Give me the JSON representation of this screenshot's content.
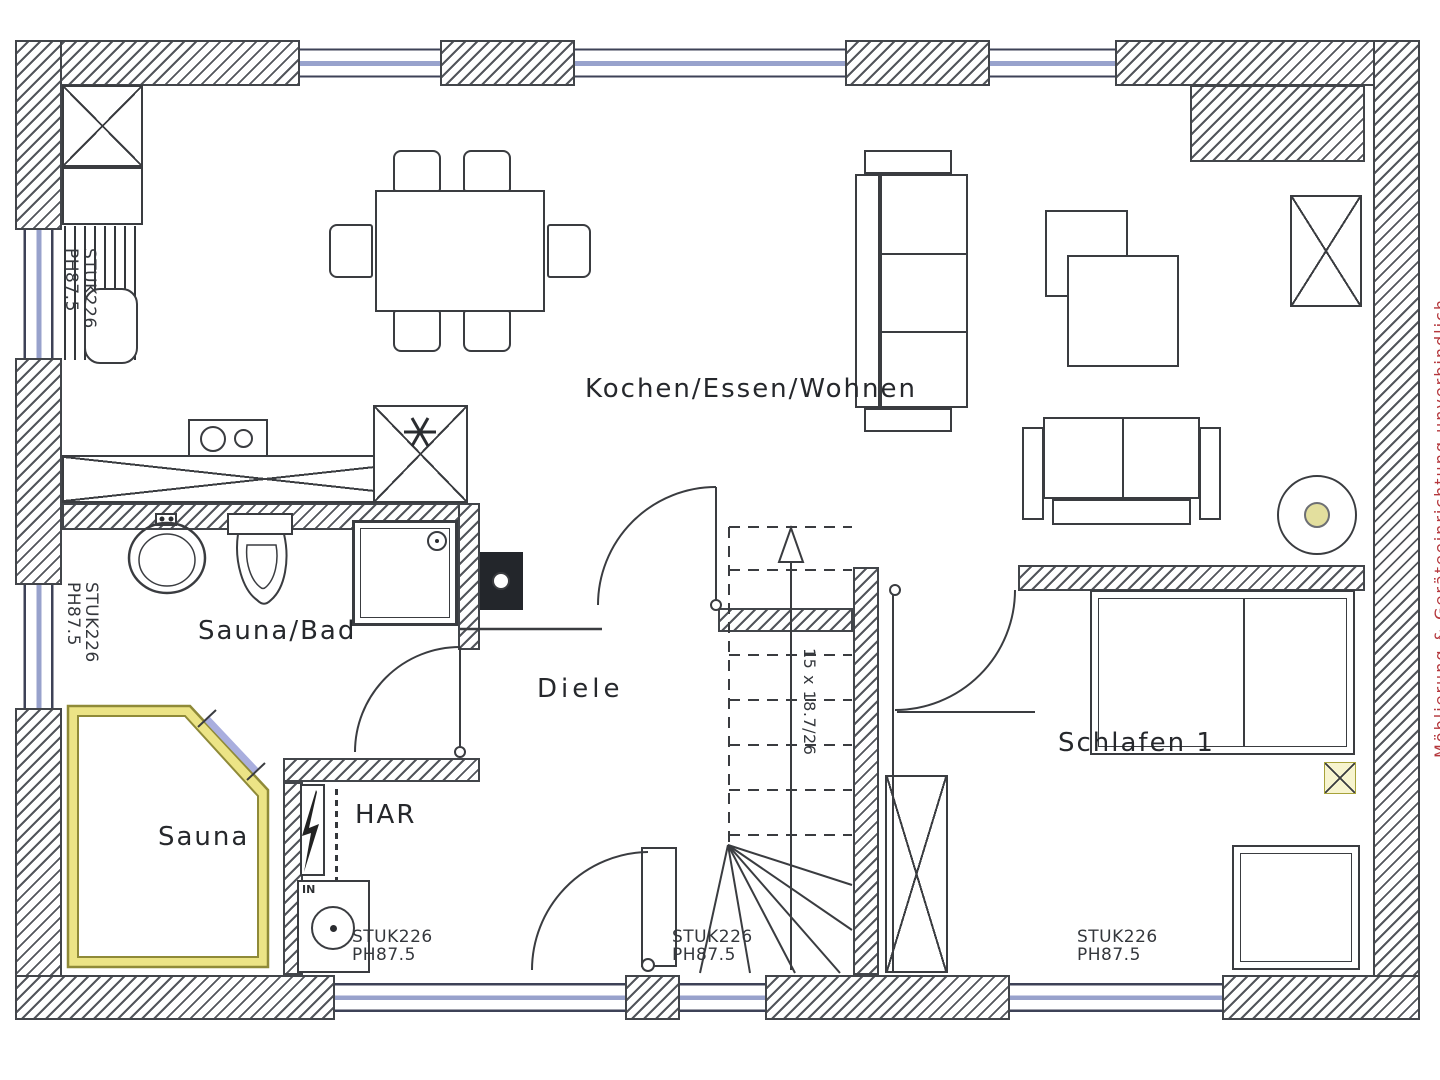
{
  "rooms": {
    "living": {
      "label": "Kochen/Essen/Wohnen"
    },
    "bath": {
      "label": "Sauna/Bad"
    },
    "hall": {
      "label": "Diele"
    },
    "sauna": {
      "label": "Sauna"
    },
    "utility": {
      "label": "HAR"
    },
    "bedroom": {
      "label": "Schlafen 1"
    }
  },
  "stairs": {
    "note": "15 x 18.7/26"
  },
  "lintel": {
    "line1": "STUK226",
    "line2": "PH87.5"
  },
  "meter": {
    "label": "IN"
  },
  "side_note": {
    "text": "Möblierung & Geräteeinrichtung unverbindlich"
  },
  "colors": {
    "line": "#3a3c40",
    "accent_red": "#b5383d",
    "sauna_wall": "#8f8a38",
    "sauna_wall_fill": "#ece486",
    "glass_door": "#a9aede",
    "window_glazing": "#98a2cc",
    "marker_yellow": "#f7f4cf"
  }
}
